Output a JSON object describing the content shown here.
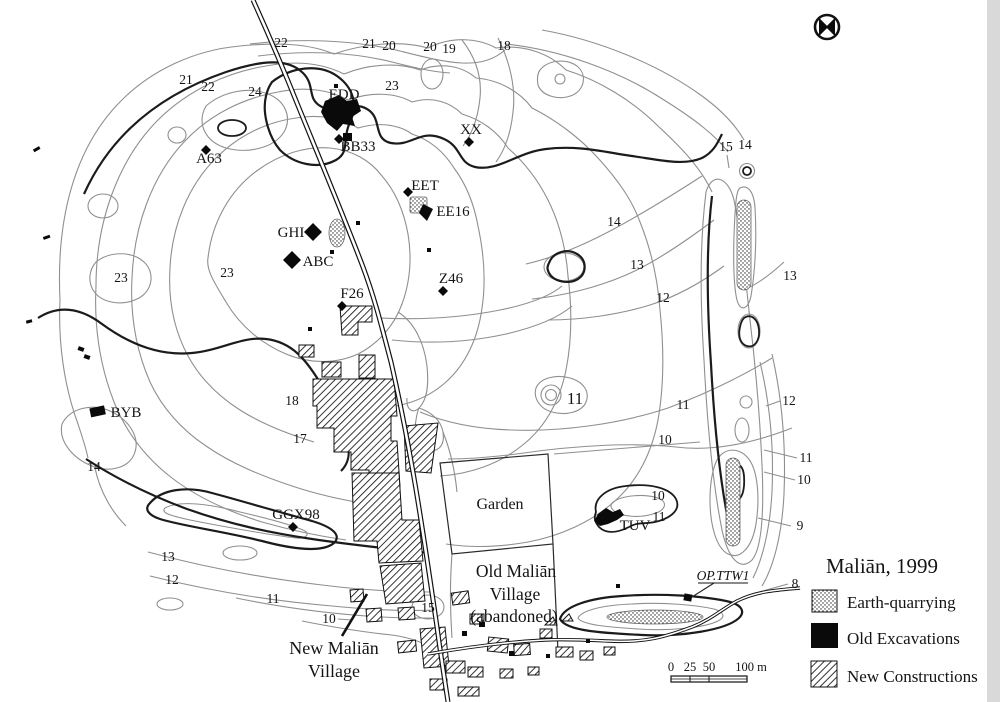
{
  "page": {
    "background": "#ffffff",
    "scan_band_color": "#d9d9d9"
  },
  "map": {
    "title": "Maliān, 1999",
    "colors": {
      "contour_light": "#8f8f8f",
      "contour_index": "#1b1b1b",
      "ink": "#141414"
    },
    "north_symbol": "circled-x-compass",
    "legend": {
      "title": "Maliān, 1999",
      "items": [
        {
          "label": "Earth-quarrying",
          "swatch": "stipple"
        },
        {
          "label": "Old Excavations",
          "swatch": "solid-black"
        },
        {
          "label": "New Constructions",
          "swatch": "diagonal-hatch"
        }
      ]
    },
    "scale_bar": {
      "tick0": "0",
      "tick1": "25",
      "tick2": "50",
      "end_label": "100 m"
    },
    "regions": {
      "garden": "Garden",
      "old_village_line1": "Old Maliān",
      "old_village_line2": "Village",
      "old_village_line3": "(abandoned)",
      "new_village_line1": "New Maliān",
      "new_village_line2": "Village"
    },
    "sites": {
      "edd": "EDD",
      "bb33": "BB33",
      "xx": "XX",
      "eet": "EET",
      "ee16": "EE16",
      "ghi": "GHI",
      "abc": "ABC",
      "z46": "Z46",
      "f26": "F26",
      "a63": "A63",
      "byb": "BYB",
      "ggx98": "GGX98",
      "tuv": "TUV",
      "op_ttw1": "OP.TTW1"
    },
    "contour_labels": [
      "22",
      "21",
      "20",
      "20",
      "19",
      "18",
      "21",
      "22",
      "24",
      "23",
      "23",
      "23",
      "15",
      "14",
      "14",
      "13",
      "12",
      "13",
      "12",
      "11",
      "10",
      "9",
      "8",
      "18",
      "17",
      "14",
      "13",
      "12",
      "11",
      "10",
      "15",
      "11",
      "11",
      "10",
      "10",
      "11"
    ]
  }
}
